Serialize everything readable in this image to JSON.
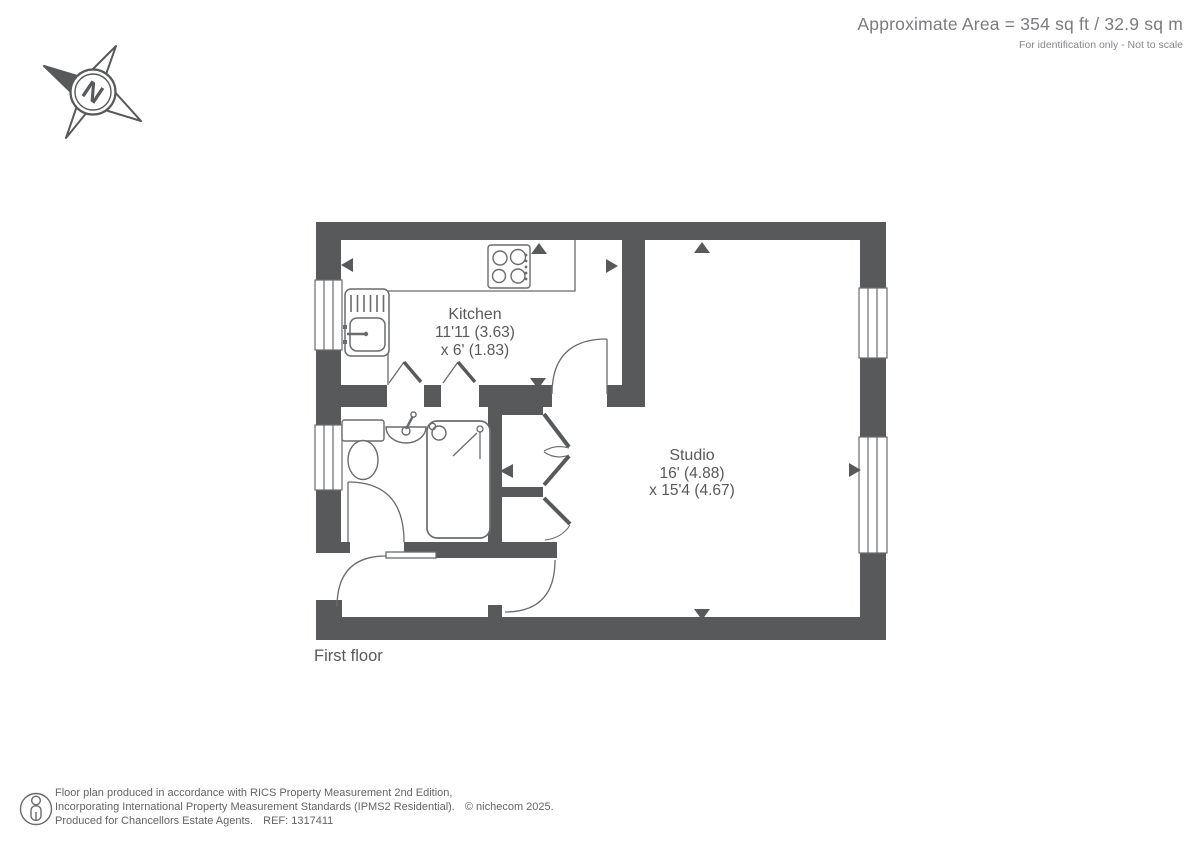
{
  "header": {
    "area": "Approximate Area = 354 sq ft / 32.9 sq m",
    "note": "For identification only - Not to scale"
  },
  "compass": {
    "north": "N"
  },
  "floorplan": {
    "floor_label": "First floor",
    "kitchen": {
      "name": "Kitchen",
      "dims1": "11'11 (3.63)",
      "dims2": "x 6' (1.83)"
    },
    "studio": {
      "name": "Studio",
      "dims1": "16' (4.88)",
      "dims2": "x 15'4 (4.67)"
    }
  },
  "footer": {
    "line1": "Floor plan produced in accordance with RICS Property Measurement 2nd Edition,",
    "line2": "Incorporating International Property Measurement Standards (IPMS2 Residential).",
    "copyright": "© nichecom 2025.",
    "line3": "Produced for Chancellors Estate Agents.",
    "ref": "REF: 1317411"
  },
  "colors": {
    "wall": "#58595B",
    "fixture_line": "#6A6B6D",
    "label_text": "#58595B",
    "header_text": "#7B7C7F",
    "footer_text": "#636466"
  }
}
